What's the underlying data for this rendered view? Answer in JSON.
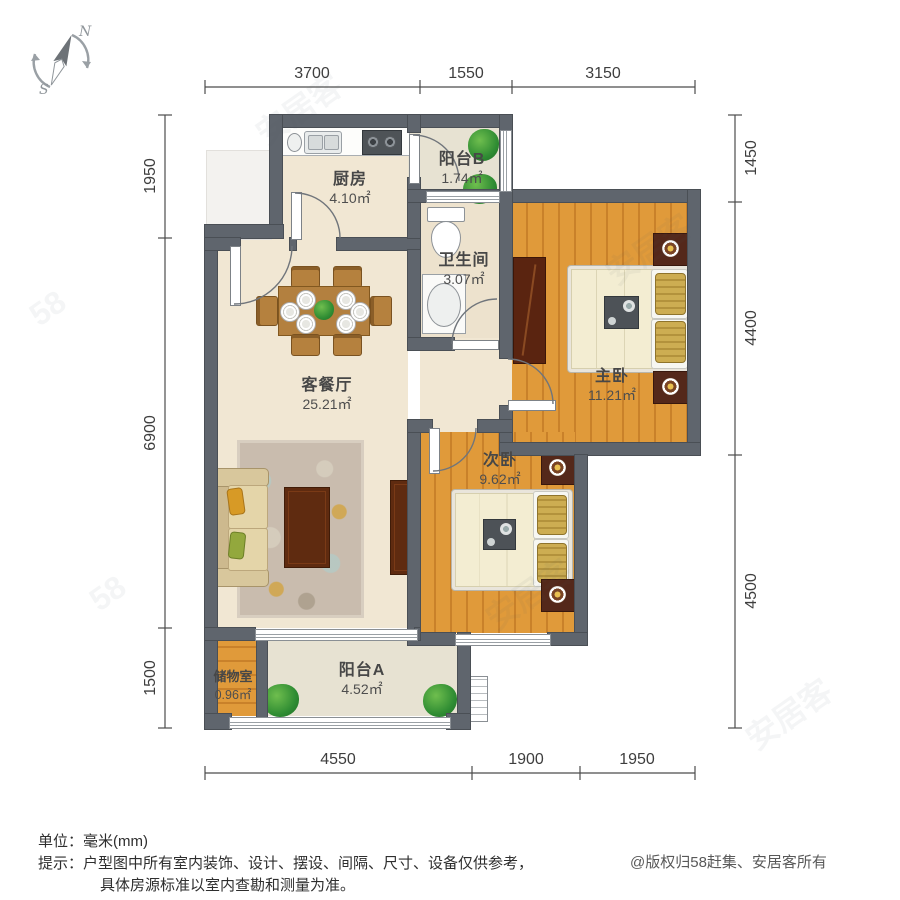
{
  "compass": {
    "north": "N",
    "south": "S"
  },
  "dimensions": {
    "top": [
      "3700",
      "1550",
      "3150"
    ],
    "bottom": [
      "4550",
      "1900",
      "1950"
    ],
    "left": [
      "1950",
      "6900",
      "1500"
    ],
    "right": [
      "1450",
      "4400",
      "4500"
    ]
  },
  "rooms": {
    "kitchen": {
      "name": "厨房",
      "area": "4.10㎡"
    },
    "balcony_b": {
      "name": "阳台B",
      "area": "1.74㎡"
    },
    "bathroom": {
      "name": "卫生间",
      "area": "3.07㎡"
    },
    "master_bedroom": {
      "name": "主卧",
      "area": "11.21㎡"
    },
    "living_dining": {
      "name": "客餐厅",
      "area": "25.21㎡"
    },
    "second_bedroom": {
      "name": "次卧",
      "area": "9.62㎡"
    },
    "storage": {
      "name": "储物室",
      "area": "0.96㎡"
    },
    "balcony_a": {
      "name": "阳台A",
      "area": "4.52㎡"
    }
  },
  "footer": {
    "unit_label": "单位：毫米(mm)",
    "tip_line1": "提示：户型图中所有室内装饰、设计、摆设、间隔、尺寸、设备仅供参考，",
    "tip_line2": "具体房源标准以室内查勘和测量为准。",
    "copyright": "@版权归58赶集、安居客所有"
  },
  "watermark": {
    "text_a": "安居客",
    "text_b": "58"
  },
  "colors": {
    "wall": "#5f656d",
    "wood_floor": "#dd9435",
    "tile_floor": "#f1e7d3",
    "plant": "#2f8c33"
  }
}
